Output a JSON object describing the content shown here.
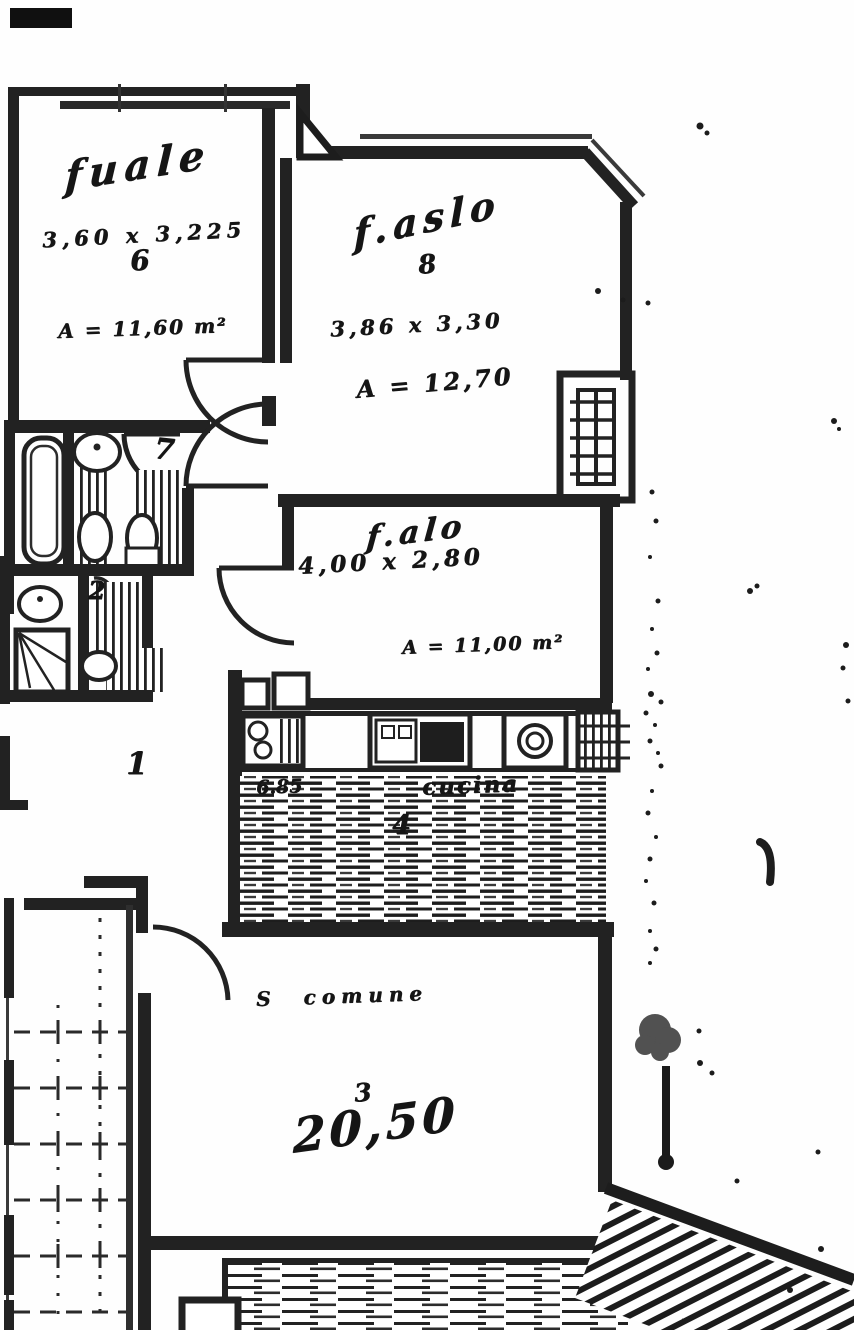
{
  "plan": {
    "room_top_left": {
      "label": "fuale",
      "dims": "3,60 x 3,225",
      "ref": "6",
      "area": "A = 11,60 m²"
    },
    "room_top_mid": {
      "label": "f.aslo",
      "ref": "8",
      "dims": "3,86 x 3,30",
      "area": "A = 12,70"
    },
    "room_mid": {
      "label": "f.alo",
      "dims": "4,00 x 2,80",
      "area": "A = 11,00 m²"
    },
    "kitchen": {
      "dim": "6.85",
      "label": "cucina",
      "ref": "4"
    },
    "living": {
      "label": "S comune",
      "ref": "3",
      "area": "20,50"
    },
    "hall": {
      "ref": "1"
    },
    "bath_main": {
      "ref": "7"
    },
    "bath_second": {
      "ref": "2"
    }
  },
  "colors": {
    "ink": "#1f1f1f",
    "paper": "#ffffff"
  }
}
